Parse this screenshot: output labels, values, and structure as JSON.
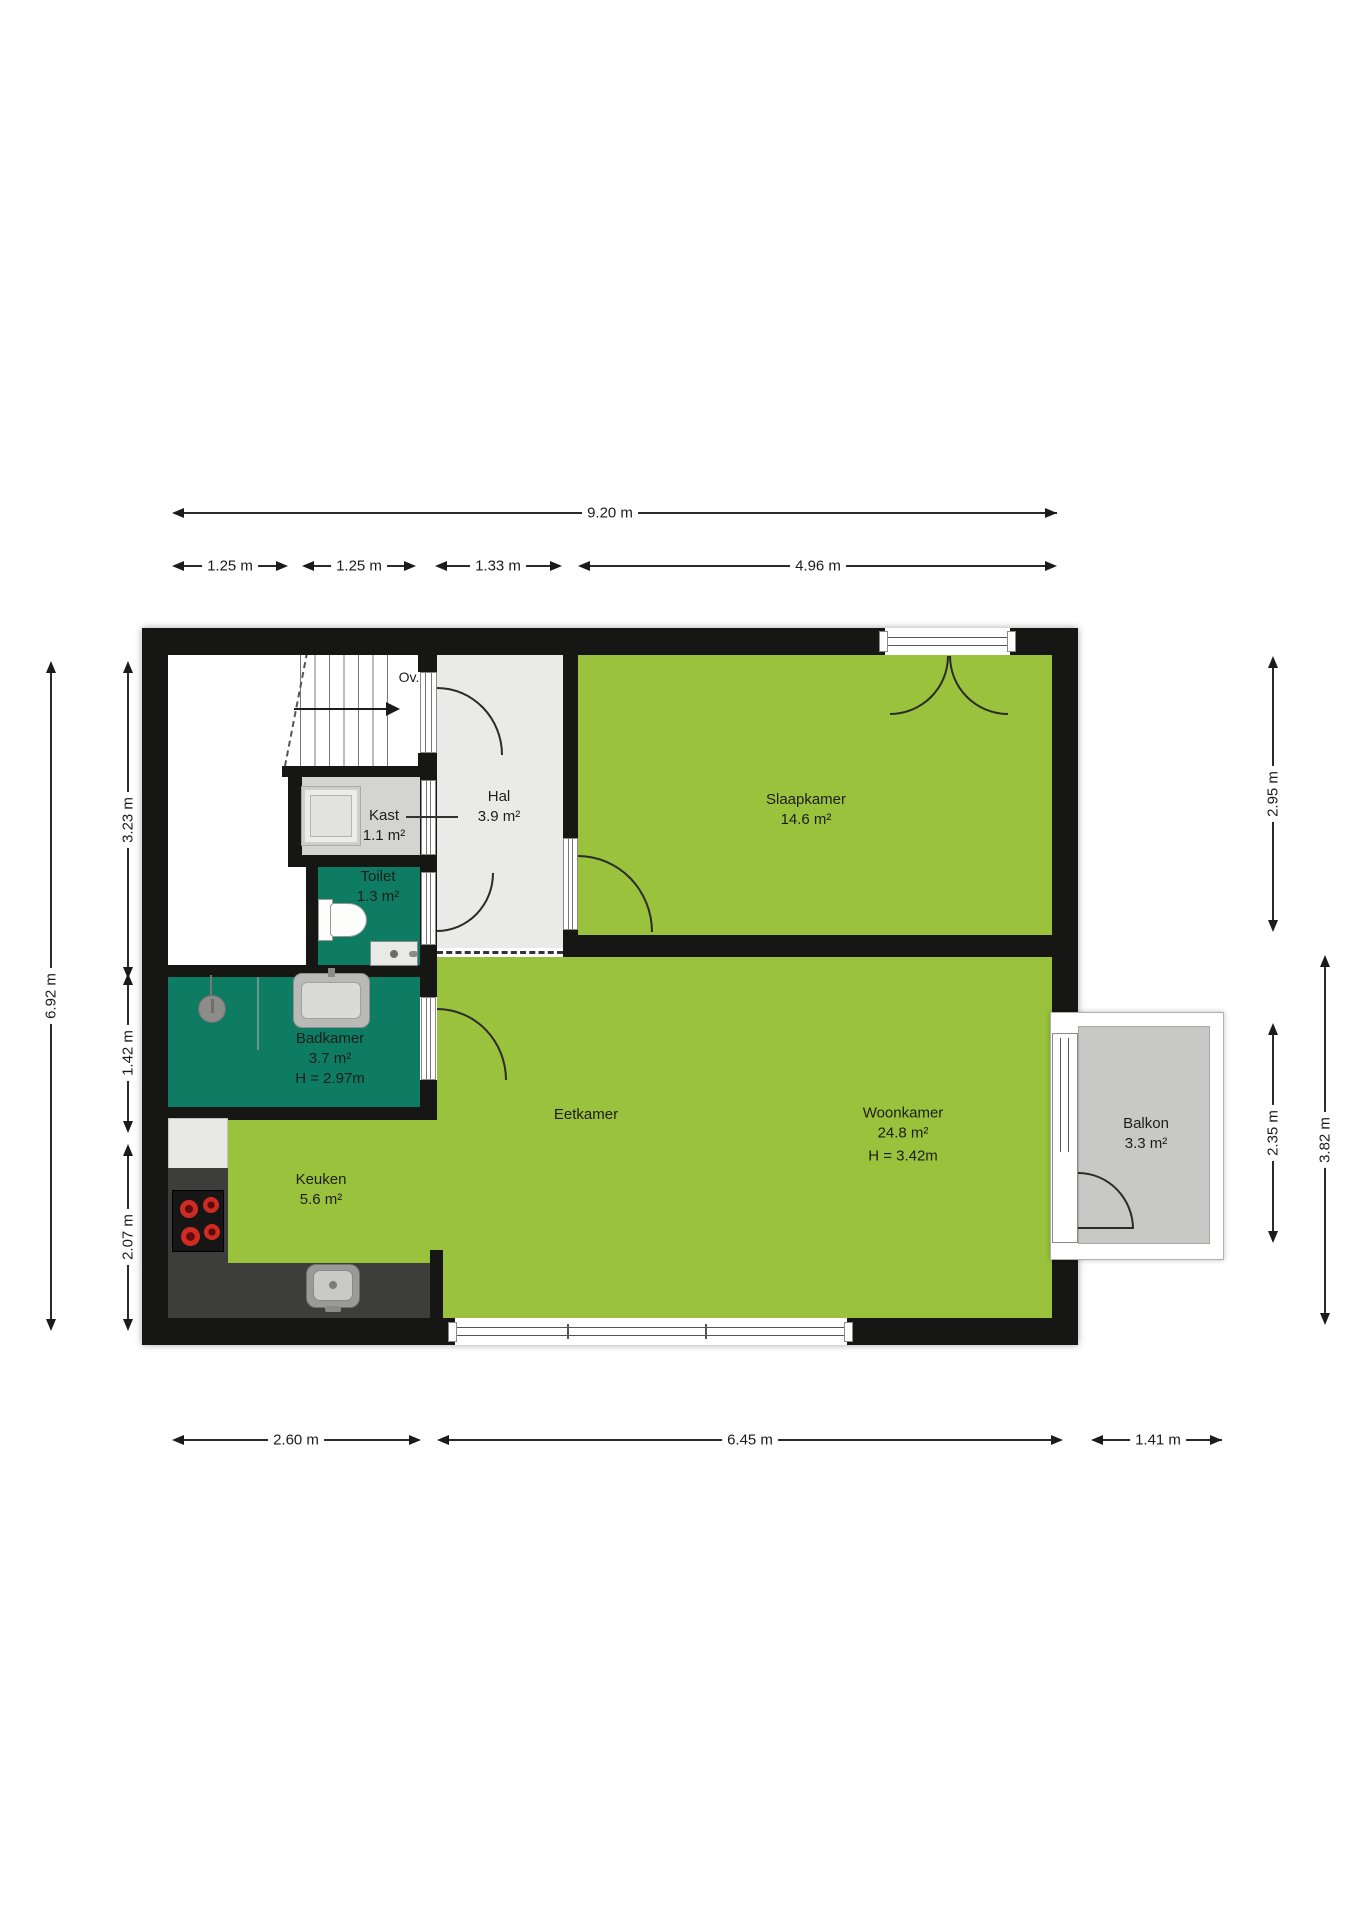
{
  "plan": {
    "title": "floor-plan",
    "stairs": {
      "label": "Ov."
    },
    "rooms": {
      "hal": {
        "name": "Hal",
        "area": "3.9 m²"
      },
      "kast": {
        "name": "Kast",
        "area": "1.1 m²"
      },
      "toilet": {
        "name": "Toilet",
        "area": "1.3 m²"
      },
      "slaapkamer": {
        "name": "Slaapkamer",
        "area": "14.6 m²"
      },
      "badkamer": {
        "name": "Badkamer",
        "area": "3.7 m²",
        "height": "H = 2.97m"
      },
      "keuken": {
        "name": "Keuken",
        "area": "5.6 m²"
      },
      "eetkamer": {
        "name": "Eetkamer"
      },
      "woonkamer": {
        "name": "Woonkamer",
        "area": "24.8 m²",
        "height": "H = 3.42m"
      },
      "balkon": {
        "name": "Balkon",
        "area": "3.3 m²"
      }
    },
    "dims": {
      "top_total": "9.20 m",
      "top_segments": [
        "1.25 m",
        "1.25 m",
        "1.33 m",
        "4.96 m"
      ],
      "bottom_segments": [
        "2.60 m",
        "6.45 m",
        "1.41 m"
      ],
      "left_total": "6.92 m",
      "left_segments": [
        "3.23 m",
        "1.42 m",
        "2.07 m"
      ],
      "right_segments": [
        "2.95 m",
        "2.35 m",
        "3.82 m"
      ]
    },
    "colors": {
      "wall": "#161614",
      "room_green": "#9ac23c",
      "room_teal": "#0e7c63",
      "hal_gray": "#eaeae8",
      "kast_gray": "#d4d4d2",
      "balcony_gray": "#c8c8c6",
      "counter_dark": "#3d3d3b",
      "burner_red": "#cf2b24"
    }
  }
}
